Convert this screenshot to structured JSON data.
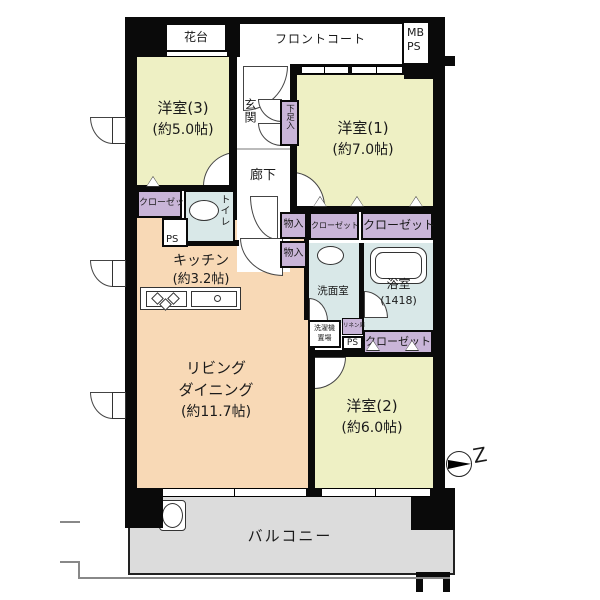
{
  "title": "マンション間取り図",
  "colors": {
    "wall": "#0a0a0a",
    "western_room": "#eef0c4",
    "kitchen_living": "#f8d9b6",
    "storage_purple": "#c9b5d8",
    "wet_area_blue": "#d9e8e8",
    "balcony_gray": "#dcdcdc"
  },
  "labels": {
    "hanadai": "花台",
    "front_court": "フロントコート",
    "mb": "MB",
    "ps_meter": "PS",
    "yoshitsu3_name": "洋室(3)",
    "yoshitsu3_size": "(約5.0帖)",
    "genkan": "玄関",
    "getabako": "下足入",
    "yoshitsu1_name": "洋室(1)",
    "yoshitsu1_size": "(約7.0帖)",
    "rouka": "廊下",
    "closet_left": "クローゼット",
    "toilet": "トイレ",
    "ps_left": "PS",
    "kitchen_name": "キッチン",
    "kitchen_size": "(約3.2帖)",
    "monoire_1": "物入",
    "monoire_2": "物入",
    "closet_small": "クローゼット",
    "closet_large": "クローゼット",
    "senmen": "洗面室",
    "bath_name": "浴室",
    "bath_size": "(1418)",
    "washer_line1": "洗濯機",
    "washer_line2": "置場",
    "linen": "リネン庫",
    "ps_bath": "PS",
    "closet_bath": "クローゼット",
    "living_line1": "リビング",
    "living_line2": "ダイニング",
    "living_size": "(約11.7帖)",
    "yoshitsu2_name": "洋室(2)",
    "yoshitsu2_size": "(約6.0帖)",
    "balcony": "バルコニー",
    "compass": "Z"
  }
}
